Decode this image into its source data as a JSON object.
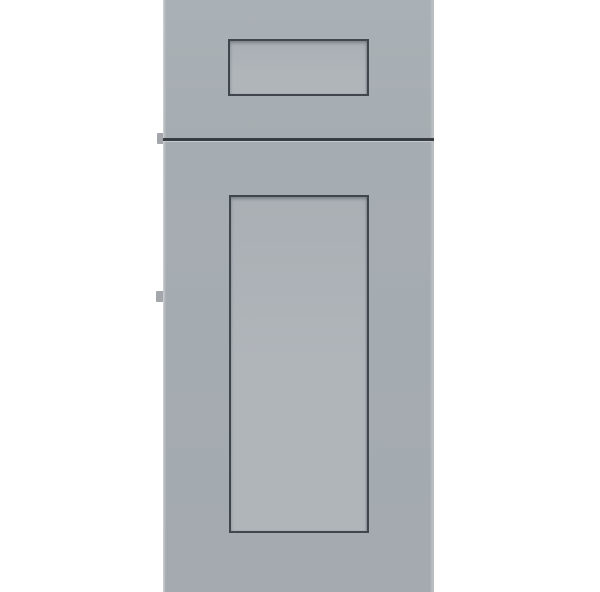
{
  "scene": {
    "description": "Gray shaker-style sample cabinet door with a small drawer front above a tall door, photographed straight-on against a white background",
    "parts": {
      "drawer_front": "drawer front with recessed rectangular center panel",
      "door": "full-height shaker door with recessed rectangular center panel",
      "divider": "dark horizontal reveal gap between drawer front and door",
      "hinge_tabs": "two small hinge bumpers protruding from the left edge"
    }
  },
  "colors": {
    "background": "#ffffff",
    "face": "#a6adb2",
    "face_top": "#aab1b6",
    "face_bottom": "#a4aab0",
    "panel": "#b0b5ba",
    "panel_top": "#a9afb4",
    "outline": "#3f464c",
    "divider": "#363c41",
    "gap_highlight": "#c6cacd",
    "edge_left": "#ced1d3",
    "edge_right": "#b9bec2",
    "hinge": "#a3a7ab"
  }
}
